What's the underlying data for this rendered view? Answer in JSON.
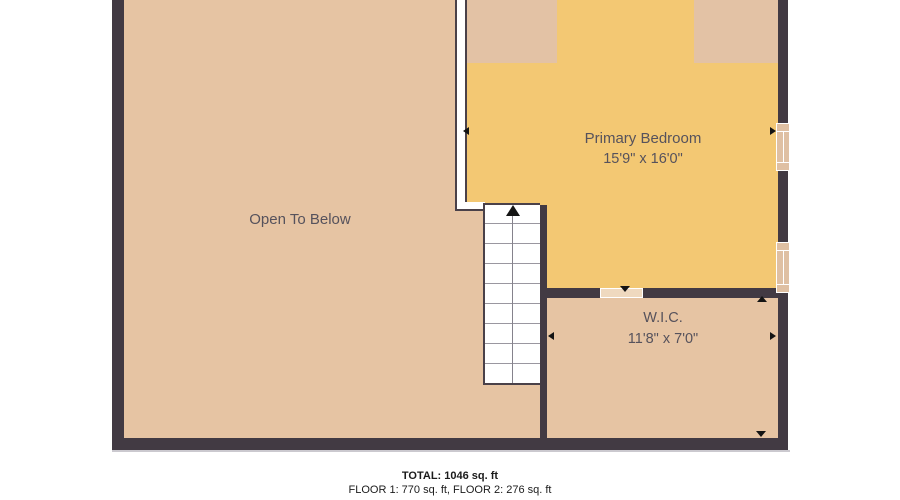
{
  "floorplan": {
    "rooms": [
      {
        "name": "Open To Below",
        "dims": ""
      },
      {
        "name": "Primary Bedroom",
        "dims": "15'9\" x 16'0\""
      },
      {
        "name": "W.I.C.",
        "dims": "11'8\" x 7'0\""
      }
    ],
    "stairs": {
      "direction": "up"
    },
    "footer": {
      "total": "TOTAL: 1046 sq. ft",
      "floors": "FLOOR 1: 770 sq. ft, FLOOR 2: 276 sq. ft"
    },
    "colors": {
      "wall": "#423A43",
      "floor_tan": "#E6C4A3",
      "bedroom_yellow": "#F3C873",
      "door_opening": "#EFD9BF",
      "window_fill": "#DFC0A3",
      "label_text": "#56525C",
      "footer_text": "#1B1B1B"
    }
  }
}
